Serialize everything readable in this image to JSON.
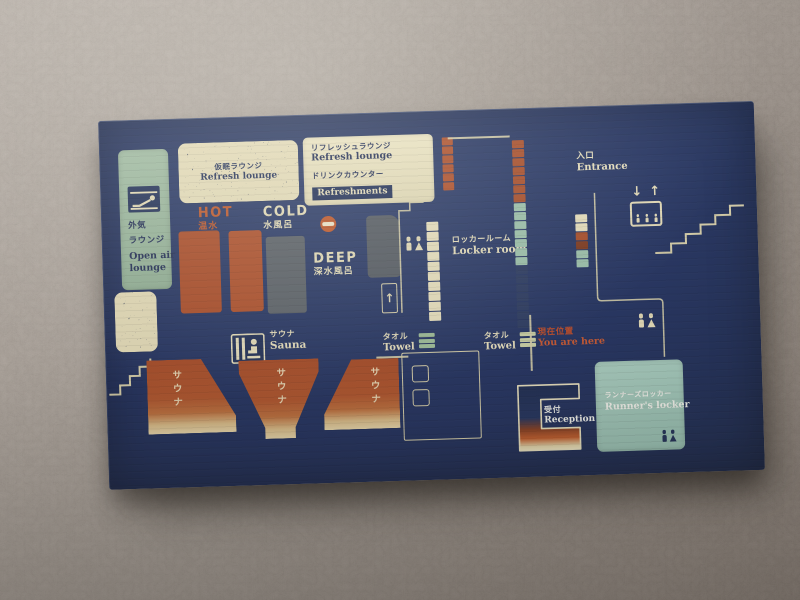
{
  "board": {
    "colors": {
      "board_navy": "#22325a",
      "cream": "#e9e2c0",
      "rust": "#b0512c",
      "sage_green": "#9cb9a3",
      "mint": "#a2cabc",
      "pool_gray": "#5d646b",
      "marker_red": "#c24e2a"
    },
    "open_air_lounge": {
      "jp_line1": "外気",
      "jp_line2": "ラウンジ",
      "en_line1": "Open air",
      "en_line2": "lounge"
    },
    "nap_lounge": {
      "jp": "仮眠ラウンジ",
      "en": "Refresh lounge"
    },
    "info_box": {
      "refresh_jp": "リフレッシュラウンジ",
      "refresh_en": "Refresh lounge",
      "drink_jp": "ドリンクカウンター",
      "drink_en": "Refreshments"
    },
    "pools": {
      "hot": {
        "en": "HOT",
        "jp": "温水"
      },
      "cold": {
        "en": "COLD",
        "jp": "水風呂"
      },
      "deep": {
        "en": "DEEP",
        "jp": "深水風呂"
      }
    },
    "sauna": {
      "jp": "サウナ",
      "en": "Sauna",
      "room_text": "サウナ"
    },
    "locker_room": {
      "jp": "ロッカールーム",
      "en": "Locker room"
    },
    "towel_mid": {
      "jp": "タオル",
      "en": "Towel"
    },
    "towel_right": {
      "jp": "タオル",
      "en": "Towel"
    },
    "you_are_here": {
      "jp": "現在位置",
      "en": "You are here"
    },
    "entrance": {
      "jp": "入口",
      "en": "Entrance"
    },
    "reception": {
      "jp": "受付",
      "en": "Reception"
    },
    "runners_locker": {
      "jp": "ランナーズロッカー",
      "en": "Runner's locker"
    },
    "icons": {
      "elevator_down": "↓",
      "elevator_up": "↑",
      "stairs_up_arrow": "↑"
    },
    "strips": {
      "snack_counter": [
        "#b0512c",
        "#b0512c",
        "#b0512c",
        "#b0512c",
        "#b0512c",
        "#b0512c"
      ],
      "locker_wall": [
        "#e9e2c0",
        "#e9e2c0",
        "#e9e2c0",
        "#e9e2c0",
        "#e9e2c0",
        "#e9e2c0",
        "#e9e2c0",
        "#e9e2c0",
        "#e9e2c0",
        "#e9e2c0"
      ],
      "locker_column": [
        "#a94e2a",
        "#a94e2a",
        "#a94e2a",
        "#a94e2a",
        "#a94e2a",
        "#a94e2a",
        "#a94e2a",
        "#9dc3ad",
        "#9dc3ad",
        "#9dc3ad",
        "#9dc3ad",
        "#9dc3ad",
        "#9dc3ad",
        "#9dc3ad",
        "#2c3c63",
        "#2c3c63",
        "#2c3c63",
        "#2c3c63",
        "#2c3c63",
        "#2c3c63",
        "#2c3c63"
      ],
      "entry_lockers": [
        "#e8e1bf",
        "#e8e1bf",
        "#a94e2a",
        "#7e3a20",
        "#9dc3ad",
        "#9dc3ad"
      ]
    }
  }
}
